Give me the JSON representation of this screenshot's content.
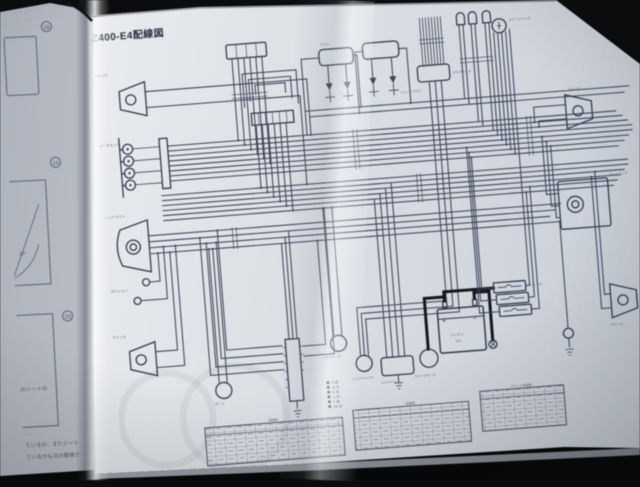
{
  "photo": {
    "background_color": "#07080a",
    "paper_color": "#dde1e6",
    "ink_color": "#3c4358"
  },
  "left_page": {
    "circled_numbers": [
      "18",
      "19",
      "20"
    ],
    "top_fragments": [
      "·········",
      "········",
      "·········",
      "·······"
    ],
    "angle_label": "30°",
    "rect3_caption": "のシートの",
    "mid_smudge": "·······",
    "bottom_lines": [
      "ているか、またシート",
      "ているかも次の要領で"
    ]
  },
  "right_page": {
    "title": "Z400-E4配線図",
    "labels": {
      "front_turn_signal_right": "ウインカ",
      "indicator_lamps": "メータランプ",
      "headlight": "ヘッドライト",
      "position_lamp": "ポジション",
      "front_turn_signal_left": "ウインカ",
      "horn": "ホーン",
      "ignition_coil": "コイル",
      "spark_plugs": "スパークプラグ",
      "alternator": "オルタネータ",
      "main_switch": "メインスイッチ",
      "tail_lamp": "テールランプ",
      "rear_turn_signal_right": "ウインカ",
      "rear_turn_signal_left": "ウインカ",
      "regulator": "レギュレータ",
      "rectifier": "レクチファイヤ",
      "starter_motor": "スタータモータ",
      "battery_name": "バッテリ",
      "battery_volts": "12V",
      "battery_plus": "+",
      "battery_minus": "−",
      "fuse": "ヒューズ",
      "igniter": "イグナイタ"
    },
    "legend": {
      "items": [
        "B 黒",
        "W 白",
        "R 赤",
        "G 緑",
        "Y 黄",
        "BR 茶"
      ]
    },
    "tables": [
      {
        "title": "結線表"
      },
      {
        "title": "結線表"
      },
      {
        "title": "スイッチ結線表"
      }
    ]
  }
}
